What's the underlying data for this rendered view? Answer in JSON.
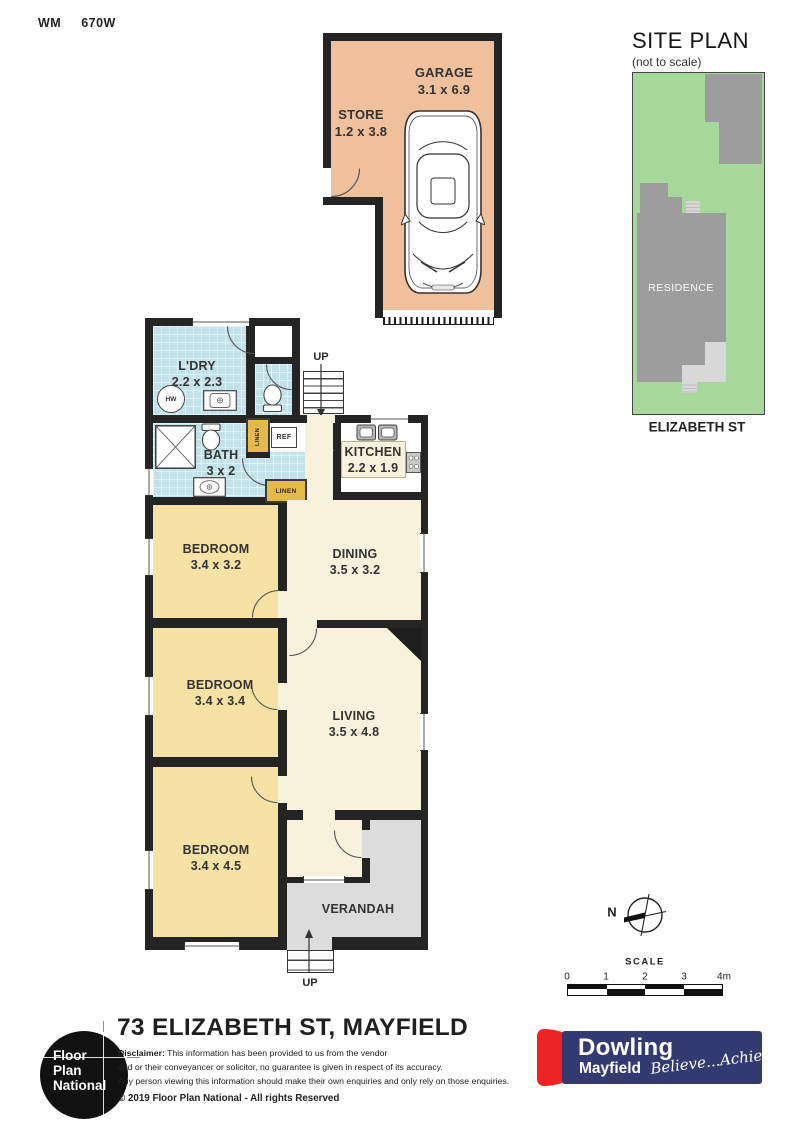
{
  "page": {
    "wm_label": "WM",
    "wm_value": "670W"
  },
  "garage_block": {
    "garage": {
      "name": "GARAGE",
      "dims": "3.1 x 6.9"
    },
    "store": {
      "name": "STORE",
      "dims": "1.2 x 3.8"
    }
  },
  "site_plan": {
    "title": "SITE PLAN",
    "subtitle": "(not to scale)",
    "residence_label": "RESIDENCE",
    "street_label": "ELIZABETH ST"
  },
  "floor_plan": {
    "ldry": {
      "name": "L'DRY",
      "dims": "2.2 x 2.3"
    },
    "bath": {
      "name": "BATH",
      "dims": "3 x 2"
    },
    "kitchen": {
      "name": "KITCHEN",
      "dims": "2.2 x 1.9"
    },
    "dining": {
      "name": "DINING",
      "dims": "3.5 x 3.2"
    },
    "living": {
      "name": "LIVING",
      "dims": "3.5 x 4.8"
    },
    "bedroom1": {
      "name": "BEDROOM",
      "dims": "3.4 x 3.2"
    },
    "bedroom2": {
      "name": "BEDROOM",
      "dims": "3.4 x 3.4"
    },
    "bedroom3": {
      "name": "BEDROOM",
      "dims": "3.4 x 4.5"
    },
    "verandah": {
      "name": "VERANDAH"
    },
    "up_label": "UP",
    "hw_label": "HW",
    "ref_label": "REF",
    "linen_label": "LINEN"
  },
  "compass": {
    "north_label": "N"
  },
  "scale_bar": {
    "title": "SCALE",
    "ticks": [
      "0",
      "1",
      "2",
      "3",
      "4m"
    ]
  },
  "footer": {
    "address": "73 ELIZABETH ST, MAYFIELD",
    "disclaimer_heading": "Disclaimer:",
    "disclaimer_lines": [
      "This information has been provided to us from the vendor",
      "and or their conveyancer or solicitor, no guarantee is given in respect of its accuracy.",
      "Any person viewing this information should make their own enquiries and only rely on those enquiries."
    ],
    "copyright": "© 2019 Floor Plan National - All rights Reserved",
    "fpn_logo_lines": [
      "Floor",
      "Plan",
      "National"
    ],
    "agency": {
      "name": "Dowling",
      "suburb": "Mayfield",
      "tagline": "Believe...Achieve"
    }
  },
  "colors": {
    "wall": "#242424",
    "garage_fill": "#f0c09d",
    "wet_room_fill": "#c2e1e8",
    "bedroom_fill": "#f6e2a4",
    "living_fill": "#f8f1db",
    "verandah_fill": "#dcdcdc",
    "linen_fill": "#e5ba4b",
    "site_grass": "#a7d79b",
    "site_building": "#9d9d9d",
    "site_light_gray": "#d8d8d8",
    "agency_navy": "#333a72",
    "agency_red": "#ee2424"
  }
}
